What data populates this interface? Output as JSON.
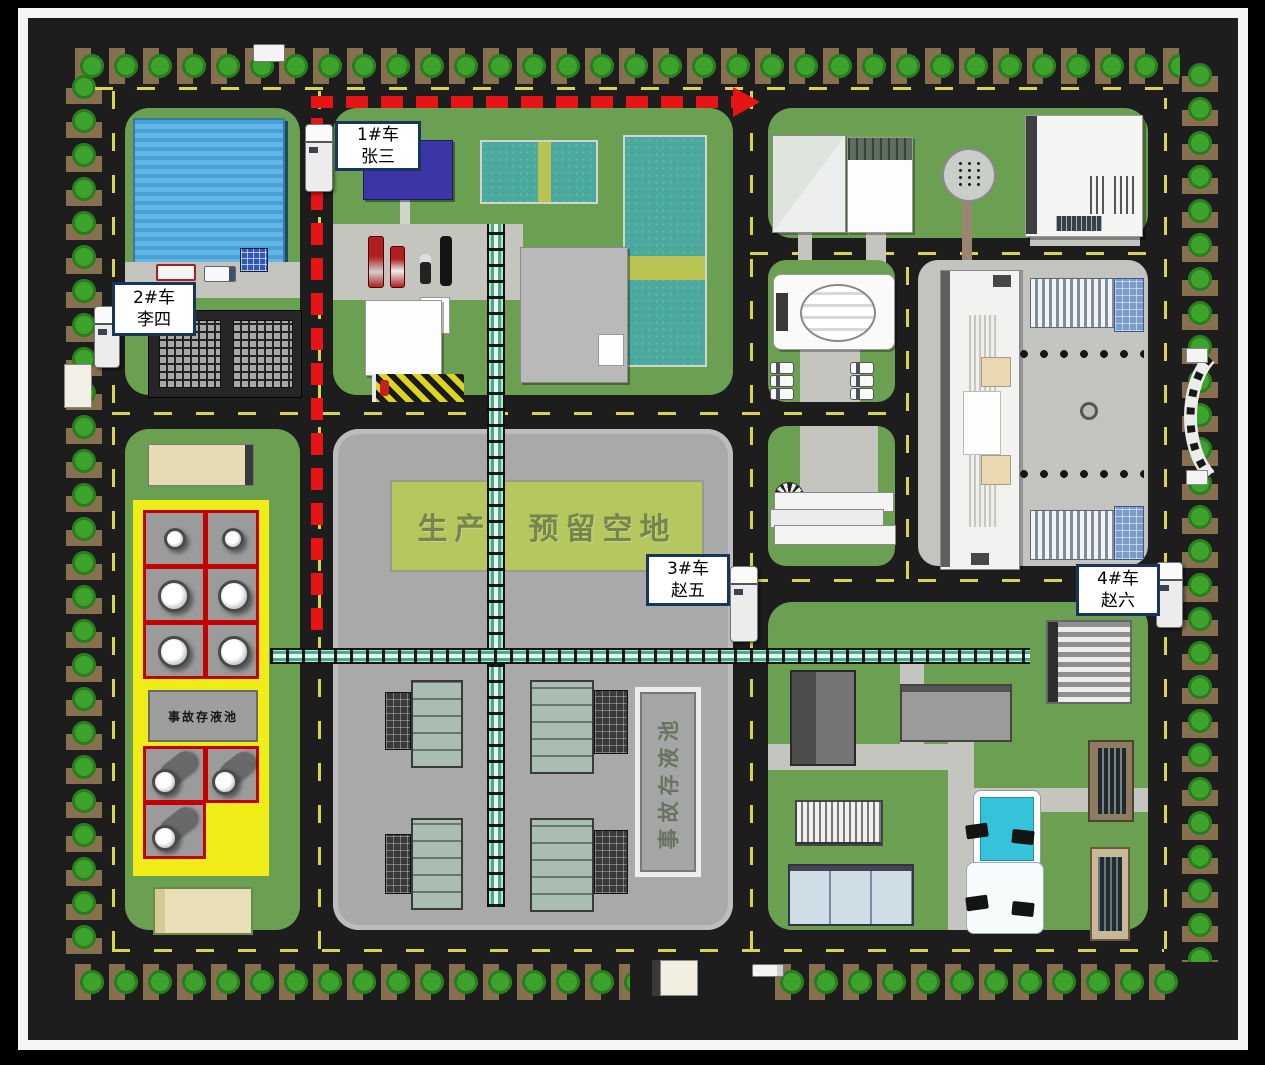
{
  "scene": {
    "type": "factory-site-plan",
    "vehicles": [
      {
        "id": "1#车",
        "driver": "张三"
      },
      {
        "id": "2#车",
        "driver": "李四"
      },
      {
        "id": "3#车",
        "driver": "赵五"
      },
      {
        "id": "4#车",
        "driver": "赵六"
      }
    ],
    "areas": {
      "reserved_land": "生产　预留空地",
      "tank_farm_accident_pool": "事故存液池",
      "production_accident_pool": "事故存液池"
    },
    "colors": {
      "route_red": "#e61414",
      "road_marking_yellow": "#d8d44e",
      "grass_green": "#6ba052",
      "dike_yellow": "#f0ec18",
      "tank_cell_red": "#c40000",
      "label_border_navy": "#17365d",
      "pool_teal": "#4ba99d",
      "warehouse_roof_blue": "#56aede",
      "reserved_land_green": "#b6c75f"
    }
  }
}
